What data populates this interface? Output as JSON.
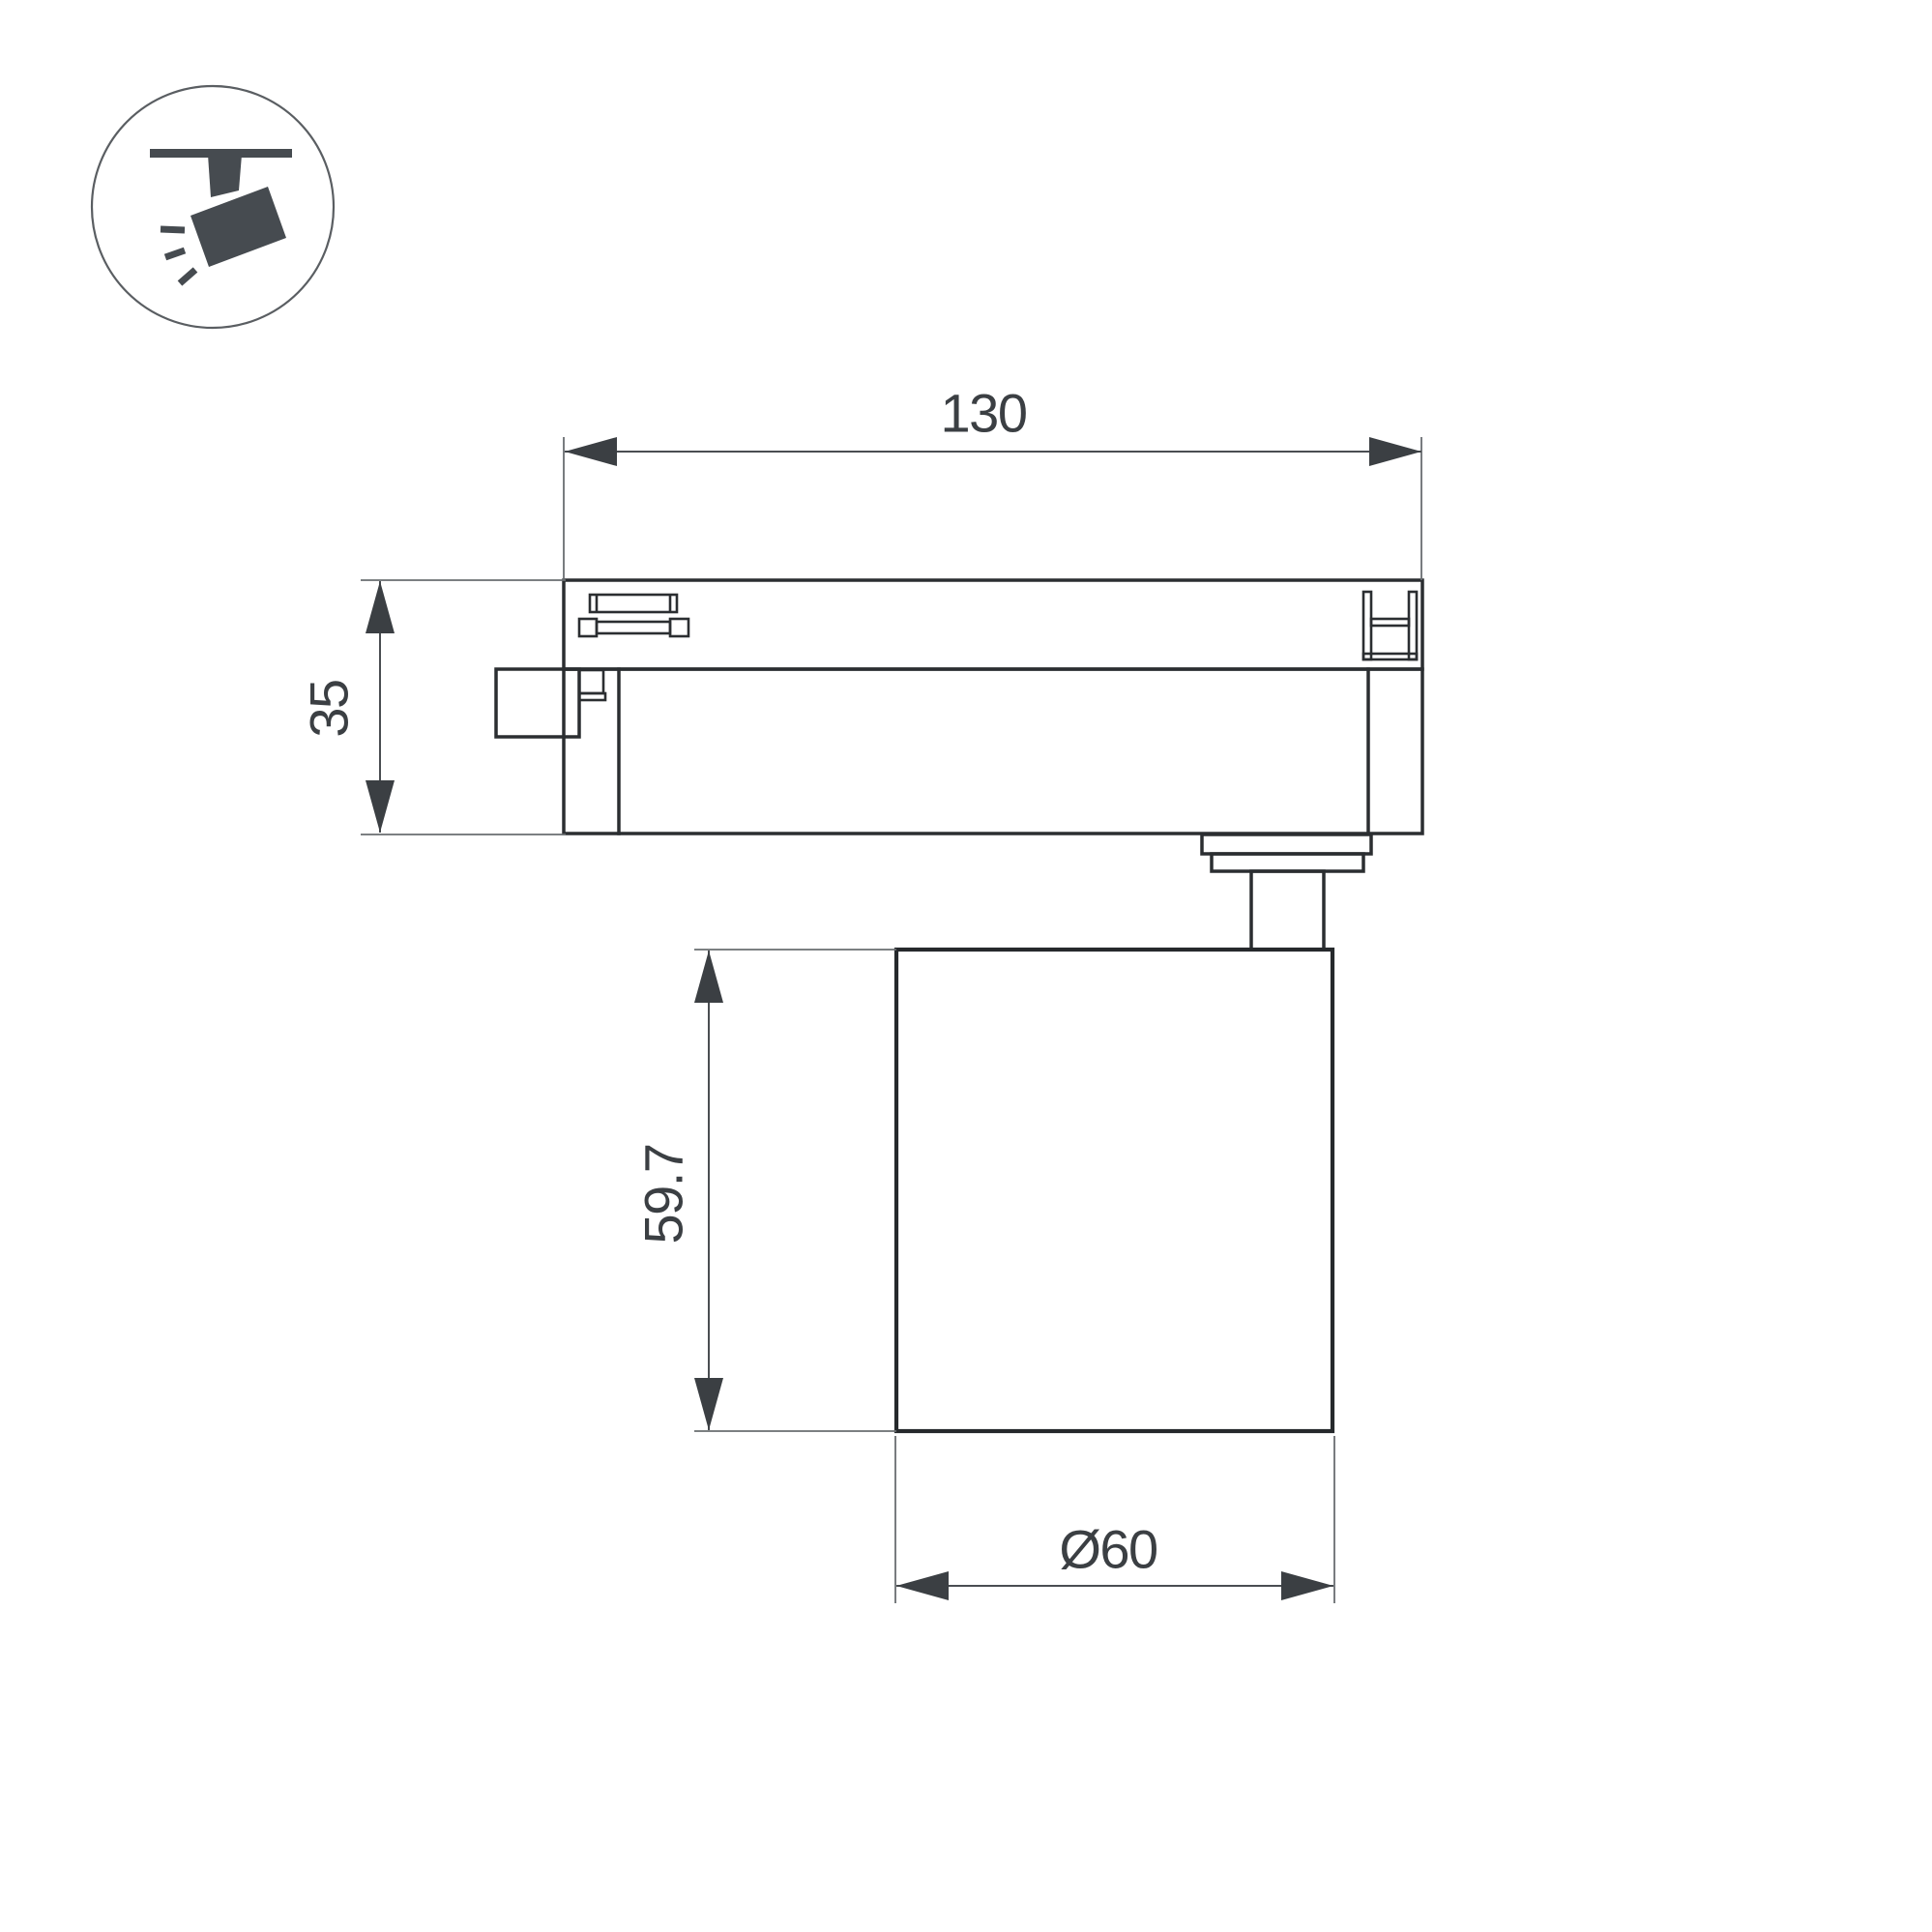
{
  "drawing": {
    "type": "technical-dimension-drawing",
    "subject": "track-mounted LED spotlight, side view",
    "dimensions": {
      "track_adapter_length": "130",
      "track_adapter_height": "35",
      "lamp_body_height": "59.7",
      "lamp_body_diameter": "Ø60"
    },
    "colors": {
      "background": "#ffffff",
      "object_outline": "#2b2e31",
      "dimension_lines": "#4a4e52",
      "dimension_text": "#3b3f43",
      "icon_fill": "#464b50"
    }
  },
  "icon": {
    "name": "track-spotlight-icon",
    "description": "spotlight hanging from ceiling track with light rays"
  }
}
